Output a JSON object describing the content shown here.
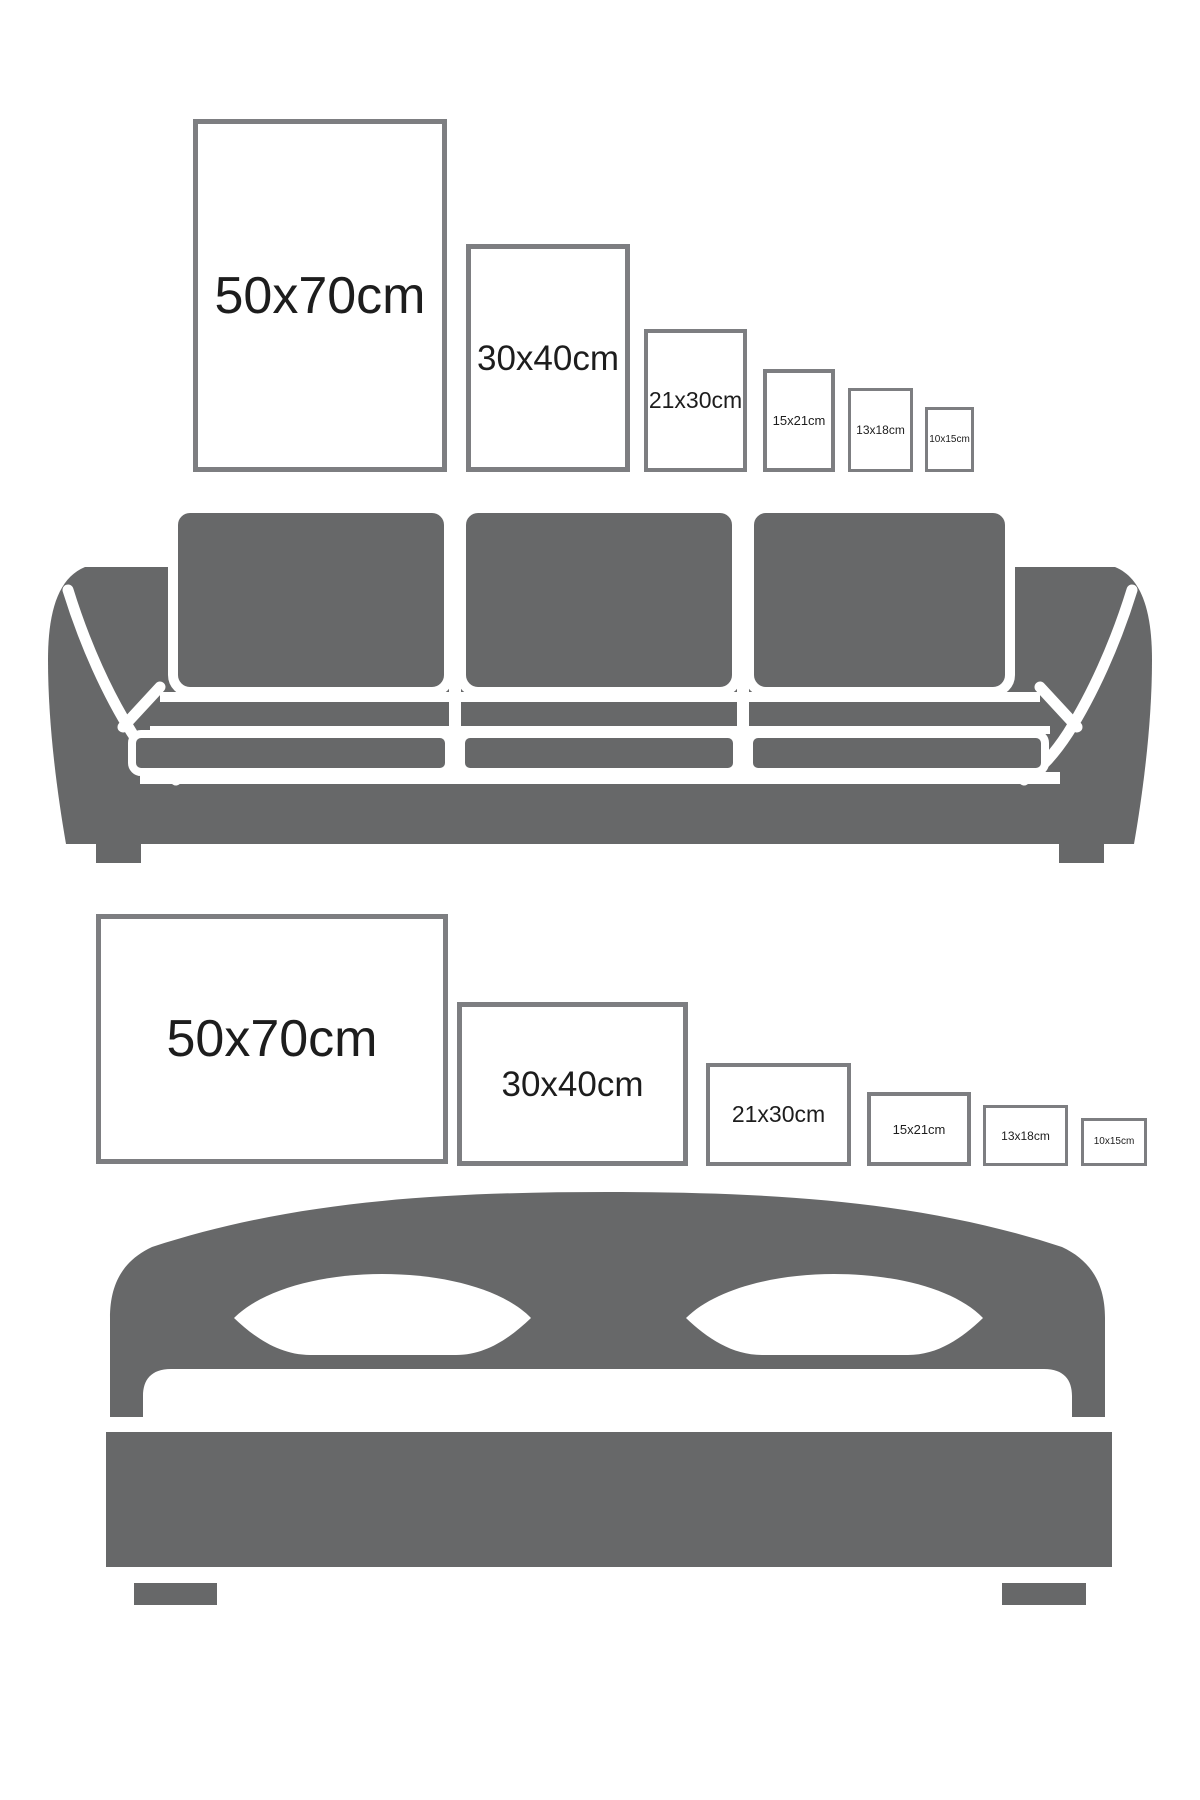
{
  "canvas": {
    "width": 1200,
    "height": 1800,
    "background": "#ffffff"
  },
  "palette": {
    "background": "#ffffff",
    "furniture_gray": "#676869",
    "frame_border_gray": "#7d7e81",
    "label_color": "#1d1d1d"
  },
  "sections": [
    {
      "id": "sofa",
      "furniture": "sofa-icon",
      "orientation": "portrait",
      "frames": [
        {
          "label": "50x70cm",
          "x": 193,
          "y": 119,
          "w": 254,
          "h": 353,
          "font": 52,
          "border": 5
        },
        {
          "label": "30x40cm",
          "x": 466,
          "y": 244,
          "w": 164,
          "h": 228,
          "font": 35,
          "border": 5
        },
        {
          "label": "21x30cm",
          "x": 644,
          "y": 329,
          "w": 103,
          "h": 143,
          "font": 23,
          "border": 4
        },
        {
          "label": "15x21cm",
          "x": 763,
          "y": 369,
          "w": 72,
          "h": 103,
          "font": 13,
          "border": 4
        },
        {
          "label": "13x18cm",
          "x": 848,
          "y": 388,
          "w": 65,
          "h": 84,
          "font": 12,
          "border": 3
        },
        {
          "label": "10x15cm",
          "x": 925,
          "y": 407,
          "w": 49,
          "h": 65,
          "font": 10,
          "border": 3
        }
      ]
    },
    {
      "id": "bed",
      "furniture": "bed-icon",
      "orientation": "landscape",
      "frames": [
        {
          "label": "50x70cm",
          "x": 96,
          "y": 914,
          "w": 352,
          "h": 250,
          "font": 52,
          "border": 5
        },
        {
          "label": "30x40cm",
          "x": 457,
          "y": 1002,
          "w": 231,
          "h": 164,
          "font": 35,
          "border": 5
        },
        {
          "label": "21x30cm",
          "x": 706,
          "y": 1063,
          "w": 145,
          "h": 103,
          "font": 23,
          "border": 4
        },
        {
          "label": "15x21cm",
          "x": 867,
          "y": 1092,
          "w": 104,
          "h": 74,
          "font": 13,
          "border": 4
        },
        {
          "label": "13x18cm",
          "x": 983,
          "y": 1105,
          "w": 85,
          "h": 61,
          "font": 12,
          "border": 3
        },
        {
          "label": "10x15cm",
          "x": 1081,
          "y": 1118,
          "w": 66,
          "h": 48,
          "font": 10,
          "border": 3
        }
      ]
    }
  ]
}
